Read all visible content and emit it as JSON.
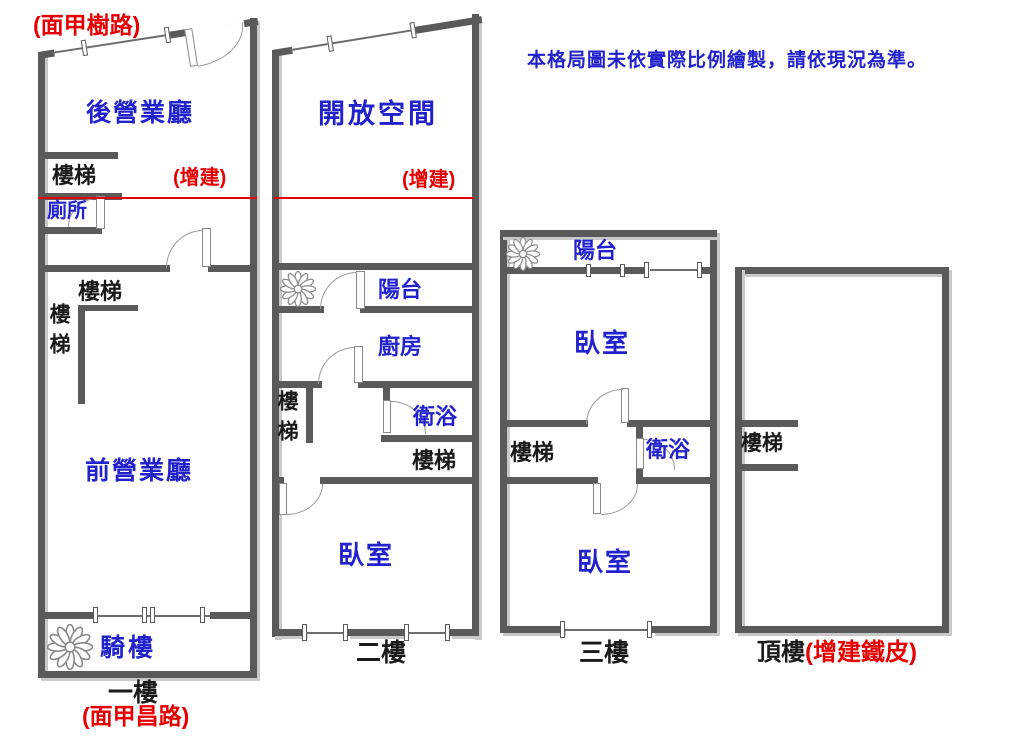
{
  "disclaimer": "本格局圖未依實際比例繪製，請依現況為準。",
  "floor1": {
    "street_top": "(面甲樹路)",
    "back_hall": "後營業廳",
    "stair_top": "樓梯",
    "addition": "(增建)",
    "toilet": "廁所",
    "stair_mid": "樓梯",
    "stair_side": "樓梯",
    "front_hall": "前營業廳",
    "arcade": "騎樓",
    "floor_label": "一樓",
    "street_bottom": "(面甲昌路)"
  },
  "floor2": {
    "open_space": "開放空間",
    "addition": "(增建)",
    "balcony": "陽台",
    "kitchen": "廚房",
    "stair_side": "樓梯",
    "bath": "衛浴",
    "stair": "樓梯",
    "bedroom": "臥室",
    "floor_label": "二樓"
  },
  "floor3": {
    "balcony": "陽台",
    "bedroom_upper": "臥室",
    "stair": "樓梯",
    "bath": "衛浴",
    "bedroom_lower": "臥室",
    "floor_label": "三樓"
  },
  "floor4": {
    "stair": "樓梯",
    "floor_label": "頂樓",
    "floor_label_note": "(增建鐵皮)"
  },
  "colors": {
    "room_label_blue": "#2222cc",
    "annotation_red": "#e60000",
    "wall_gray": "#5a5a5a"
  }
}
